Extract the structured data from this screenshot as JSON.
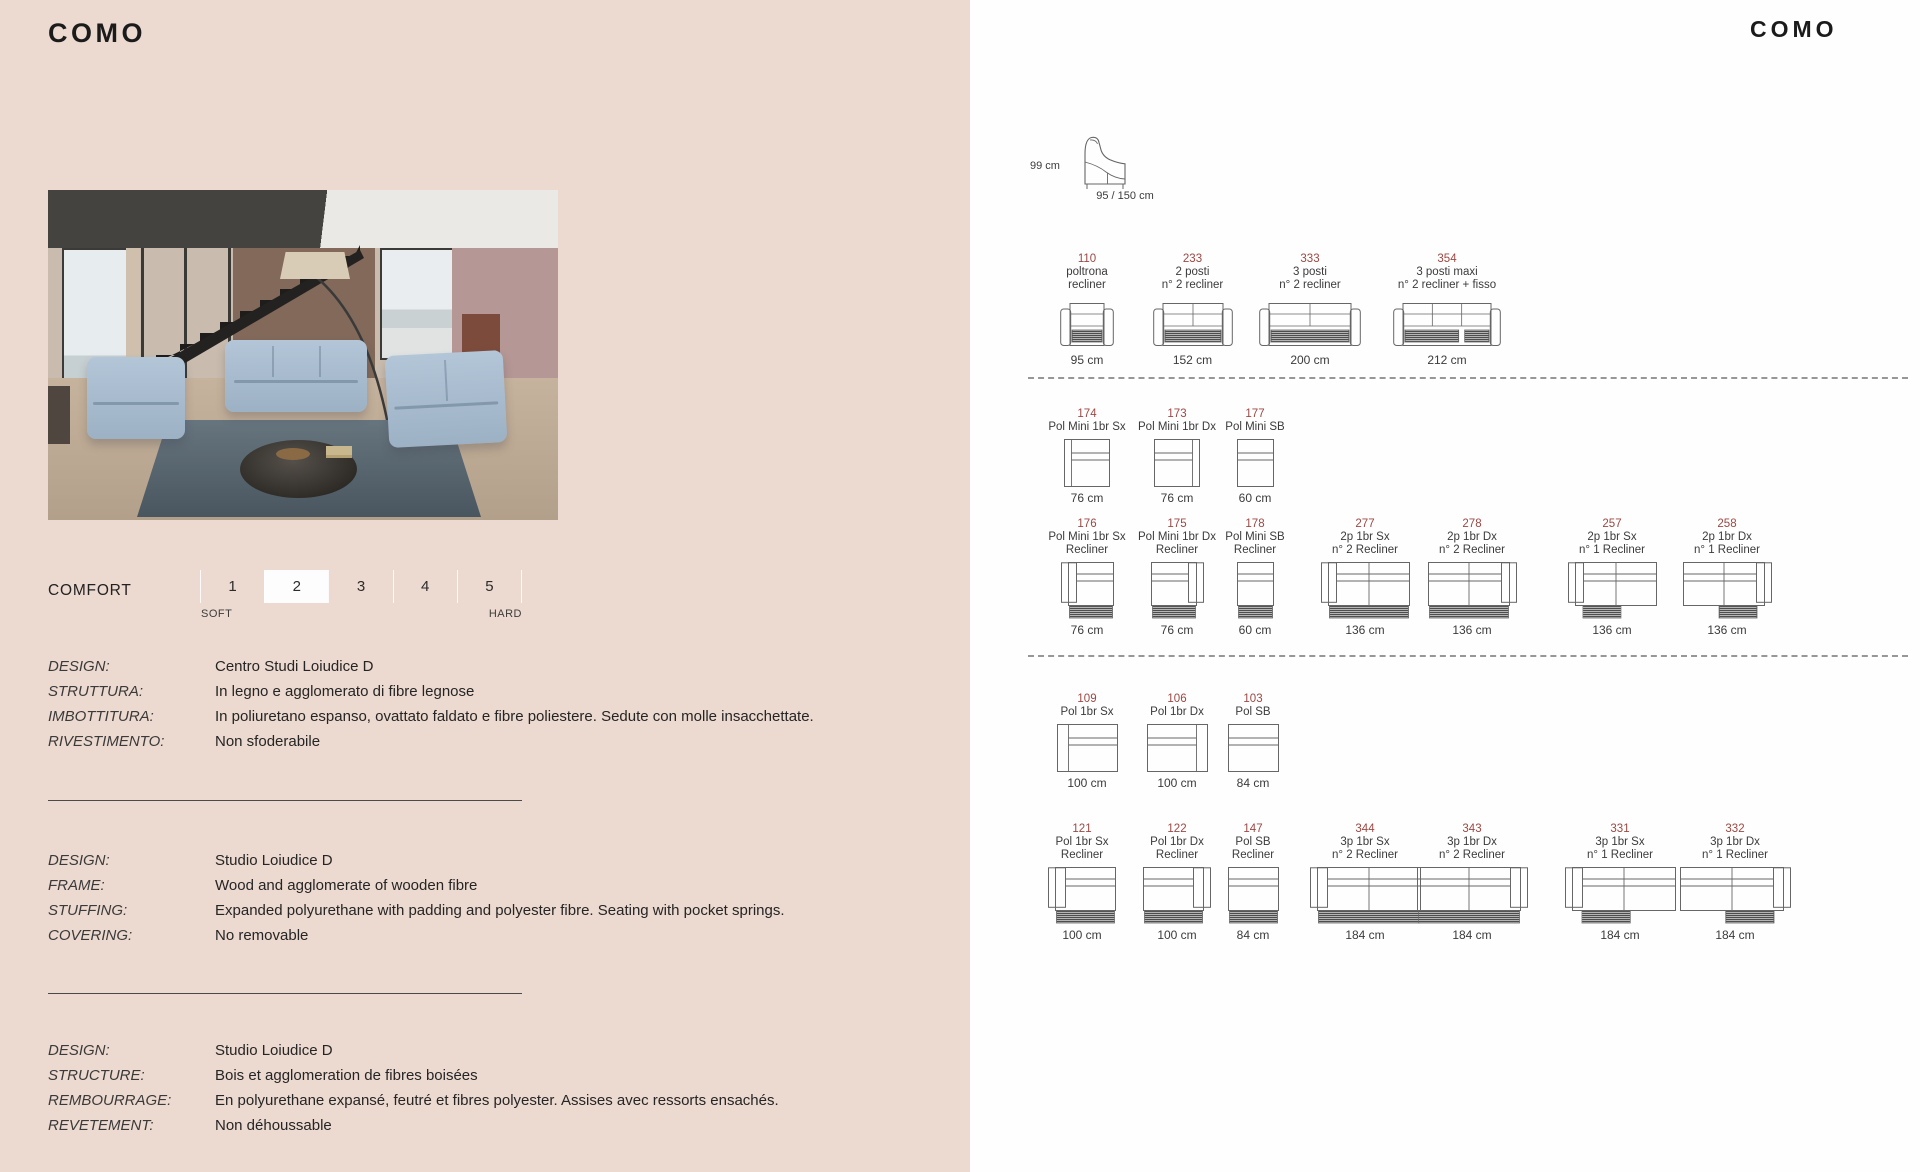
{
  "left": {
    "title": "COMO",
    "comfort": {
      "label": "COMFORT",
      "soft": "SOFT",
      "hard": "HARD",
      "levels": [
        "1",
        "2",
        "3",
        "4",
        "5"
      ],
      "selected": "2"
    },
    "spec_blocks": [
      {
        "id": "it",
        "rows": [
          [
            "DESIGN:",
            "Centro Studi Loiudice D"
          ],
          [
            "STRUTTURA:",
            "In legno e agglomerato di fibre legnose"
          ],
          [
            "IMBOTTITURA:",
            "In poliuretano espanso, ovattato faldato e fibre poliestere. Sedute con molle insacchettate."
          ],
          [
            "RIVESTIMENTO:",
            "Non sfoderabile"
          ]
        ]
      },
      {
        "id": "en",
        "rows": [
          [
            "DESIGN:",
            "Studio Loiudice D"
          ],
          [
            "FRAME:",
            "Wood and agglomerate of wooden fibre"
          ],
          [
            "STUFFING:",
            "Expanded polyurethane with padding and polyester fibre. Seating with pocket springs."
          ],
          [
            "COVERING:",
            "No removable"
          ]
        ]
      },
      {
        "id": "fr",
        "rows": [
          [
            "DESIGN:",
            "Studio Loiudice D"
          ],
          [
            "STRUCTURE:",
            "Bois et agglomeration de fibres boisées"
          ],
          [
            "REMBOURRAGE:",
            "En polyurethane expansé, feutré et fibres polyester. Assises avec ressorts ensachés."
          ],
          [
            "REVETEMENT:",
            "Non déhoussable"
          ]
        ]
      }
    ]
  },
  "right": {
    "title": "COMO",
    "side_view": {
      "height": "99 cm",
      "depth": "95 / 150 cm"
    },
    "rows": [
      {
        "id": "row1",
        "cells": [
          {
            "code": "110",
            "name": [
              "poltrona",
              "recliner"
            ],
            "dim": "95 cm",
            "draw": {
              "type": "front",
              "w": 54,
              "seats": 1,
              "hatch": "all"
            }
          },
          {
            "code": "233",
            "name": [
              "2 posti",
              "n° 2 recliner"
            ],
            "dim": "152 cm",
            "draw": {
              "type": "front",
              "w": 80,
              "seats": 2,
              "hatch": "all"
            }
          },
          {
            "code": "333",
            "name": [
              "3 posti",
              "n° 2 recliner"
            ],
            "dim": "200 cm",
            "draw": {
              "type": "front",
              "w": 102,
              "seats": 2,
              "hatch": "all"
            }
          },
          {
            "code": "354",
            "name": [
              "3 posti maxi",
              "n° 2 recliner + fisso"
            ],
            "dim": "212 cm",
            "draw": {
              "type": "front",
              "w": 108,
              "seats": 3,
              "hatch": "outer"
            }
          }
        ]
      },
      {
        "id": "row2",
        "cells": [
          {
            "code": "174",
            "name": [
              "Pol Mini 1br Sx"
            ],
            "dim": "76 cm",
            "draw": {
              "type": "top",
              "w": 46,
              "arm": "sx",
              "aw": 7
            }
          },
          {
            "code": "173",
            "name": [
              "Pol Mini 1br Dx"
            ],
            "dim": "76 cm",
            "draw": {
              "type": "top",
              "w": 46,
              "arm": "dx",
              "aw": 7
            }
          },
          {
            "code": "177",
            "name": [
              "Pol Mini SB"
            ],
            "dim": "60 cm",
            "draw": {
              "type": "top",
              "w": 37,
              "arm": "sb",
              "aw": 0
            }
          }
        ]
      },
      {
        "id": "row3",
        "cells": [
          {
            "code": "176",
            "name": [
              "Pol Mini 1br Sx",
              "Recliner"
            ],
            "dim": "76 cm",
            "draw": {
              "type": "topr",
              "w": 46,
              "arm": "sx",
              "aw": 8,
              "seats": 1,
              "hatch": "all"
            }
          },
          {
            "code": "175",
            "name": [
              "Pol Mini 1br Dx",
              "Recliner"
            ],
            "dim": "76 cm",
            "draw": {
              "type": "topr",
              "w": 46,
              "arm": "dx",
              "aw": 8,
              "seats": 1,
              "hatch": "all"
            }
          },
          {
            "code": "178",
            "name": [
              "Pol Mini SB",
              "Recliner"
            ],
            "dim": "60 cm",
            "draw": {
              "type": "topr",
              "w": 37,
              "arm": "sb",
              "aw": 0,
              "seats": 1,
              "hatch": "all"
            }
          },
          {
            "code": "277",
            "name": [
              "2p 1br Sx",
              "n° 2 Recliner"
            ],
            "dim": "136 cm",
            "draw": {
              "type": "topr",
              "w": 82,
              "arm": "sx",
              "aw": 8,
              "seats": 2,
              "hatch": "all"
            }
          },
          {
            "code": "278",
            "name": [
              "2p 1br Dx",
              "n° 2 Recliner"
            ],
            "dim": "136 cm",
            "draw": {
              "type": "topr",
              "w": 82,
              "arm": "dx",
              "aw": 8,
              "seats": 2,
              "hatch": "all"
            }
          },
          {
            "code": "257",
            "name": [
              "2p 1br Sx",
              "n° 1 Recliner"
            ],
            "dim": "136 cm",
            "draw": {
              "type": "topr",
              "w": 82,
              "arm": "sx",
              "aw": 8,
              "seats": 2,
              "hatch": "near"
            }
          },
          {
            "code": "258",
            "name": [
              "2p 1br Dx",
              "n° 1 Recliner"
            ],
            "dim": "136 cm",
            "draw": {
              "type": "topr",
              "w": 82,
              "arm": "dx",
              "aw": 8,
              "seats": 2,
              "hatch": "near"
            }
          }
        ]
      },
      {
        "id": "row4",
        "cells": [
          {
            "code": "109",
            "name": [
              "Pol 1br Sx"
            ],
            "dim": "100 cm",
            "draw": {
              "type": "top",
              "w": 61,
              "arm": "sx",
              "aw": 11
            }
          },
          {
            "code": "106",
            "name": [
              "Pol 1br Dx"
            ],
            "dim": "100 cm",
            "draw": {
              "type": "top",
              "w": 61,
              "arm": "dx",
              "aw": 11
            }
          },
          {
            "code": "103",
            "name": [
              "Pol SB"
            ],
            "dim": "84 cm",
            "draw": {
              "type": "top",
              "w": 51,
              "arm": "sb",
              "aw": 0
            }
          }
        ]
      },
      {
        "id": "row5",
        "cells": [
          {
            "code": "121",
            "name": [
              "Pol 1br Sx",
              "Recliner"
            ],
            "dim": "100 cm",
            "draw": {
              "type": "topr",
              "w": 61,
              "arm": "sx",
              "aw": 10,
              "seats": 1,
              "hatch": "all"
            }
          },
          {
            "code": "122",
            "name": [
              "Pol 1br Dx",
              "Recliner"
            ],
            "dim": "100 cm",
            "draw": {
              "type": "topr",
              "w": 61,
              "arm": "dx",
              "aw": 10,
              "seats": 1,
              "hatch": "all"
            }
          },
          {
            "code": "147",
            "name": [
              "Pol SB",
              "Recliner"
            ],
            "dim": "84 cm",
            "draw": {
              "type": "topr",
              "w": 51,
              "arm": "sb",
              "aw": 0,
              "seats": 1,
              "hatch": "all"
            }
          },
          {
            "code": "344",
            "name": [
              "3p 1br Sx",
              "n° 2 Recliner"
            ],
            "dim": "184 cm",
            "draw": {
              "type": "topr",
              "w": 104,
              "arm": "sx",
              "aw": 10,
              "seats": 2,
              "hatch": "all"
            }
          },
          {
            "code": "343",
            "name": [
              "3p 1br Dx",
              "n° 2 Recliner"
            ],
            "dim": "184 cm",
            "draw": {
              "type": "topr",
              "w": 104,
              "arm": "dx",
              "aw": 10,
              "seats": 2,
              "hatch": "all"
            }
          },
          {
            "code": "331",
            "name": [
              "3p 1br Sx",
              "n° 1 Recliner"
            ],
            "dim": "184 cm",
            "draw": {
              "type": "topr",
              "w": 104,
              "arm": "sx",
              "aw": 10,
              "seats": 2,
              "hatch": "near"
            }
          },
          {
            "code": "332",
            "name": [
              "3p 1br Dx",
              "n° 1 Recliner"
            ],
            "dim": "184 cm",
            "draw": {
              "type": "topr",
              "w": 104,
              "arm": "dx",
              "aw": 10,
              "seats": 2,
              "hatch": "near"
            }
          }
        ]
      }
    ]
  },
  "colors": {
    "background_left": "#ecd9cf",
    "background_right": "#fefefe",
    "code_accent": "#9c4843",
    "line": "#666666"
  }
}
